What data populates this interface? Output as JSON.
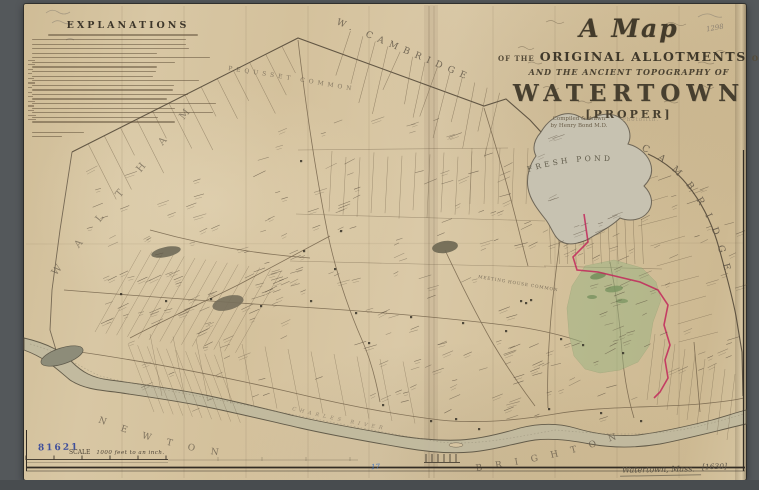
{
  "window": {
    "background": "#54585b"
  },
  "title_block": {
    "script_title": "A Map",
    "line2_prefix": "OF THE",
    "line2_main": "ORIGINAL ALLOTMENTS",
    "line2_suffix": "OF LAND",
    "line3": "AND THE ANCIENT TOPOGRAPHY OF",
    "town_name": "WATERTOWN",
    "proper": "[PROPER]",
    "credit_line1": "Compiled & drawn",
    "credit_line2": "by Henry Bond M.D.",
    "photolith_note": "Photolith."
  },
  "explanations": {
    "title": "EXPLANATIONS"
  },
  "boundary_labels": {
    "top": "W. CAMBRIDGE",
    "right": "CAMBRIDGE",
    "left": "WALTHAM",
    "bottom_left": "NEWTON",
    "bottom_right": "BRIGHTON"
  },
  "water_labels": {
    "pond": "FRESH POND",
    "river": "CHARLES RIVER"
  },
  "place_labels": {
    "pequusset_common": "PEQUSSET COMMON",
    "meeting_house_common": "MEETING HOUSE COMMON"
  },
  "scale_bar": {
    "label": "SCALE",
    "text": "1000 feet to an inch."
  },
  "annotations": {
    "catalog_stamp": "81621",
    "bottom_title": "Watertown, Mass.",
    "bottom_year": "[1630]",
    "pencil_note": "1298",
    "blue_mark": "17"
  },
  "colors": {
    "paper": "#d6c4a1",
    "ink": "#4a4134",
    "boundary_red": "#c2275a",
    "allotment_green": "#9ab482",
    "stamp_blue": "#2b3f9b",
    "water_gray": "#c3bda6"
  }
}
